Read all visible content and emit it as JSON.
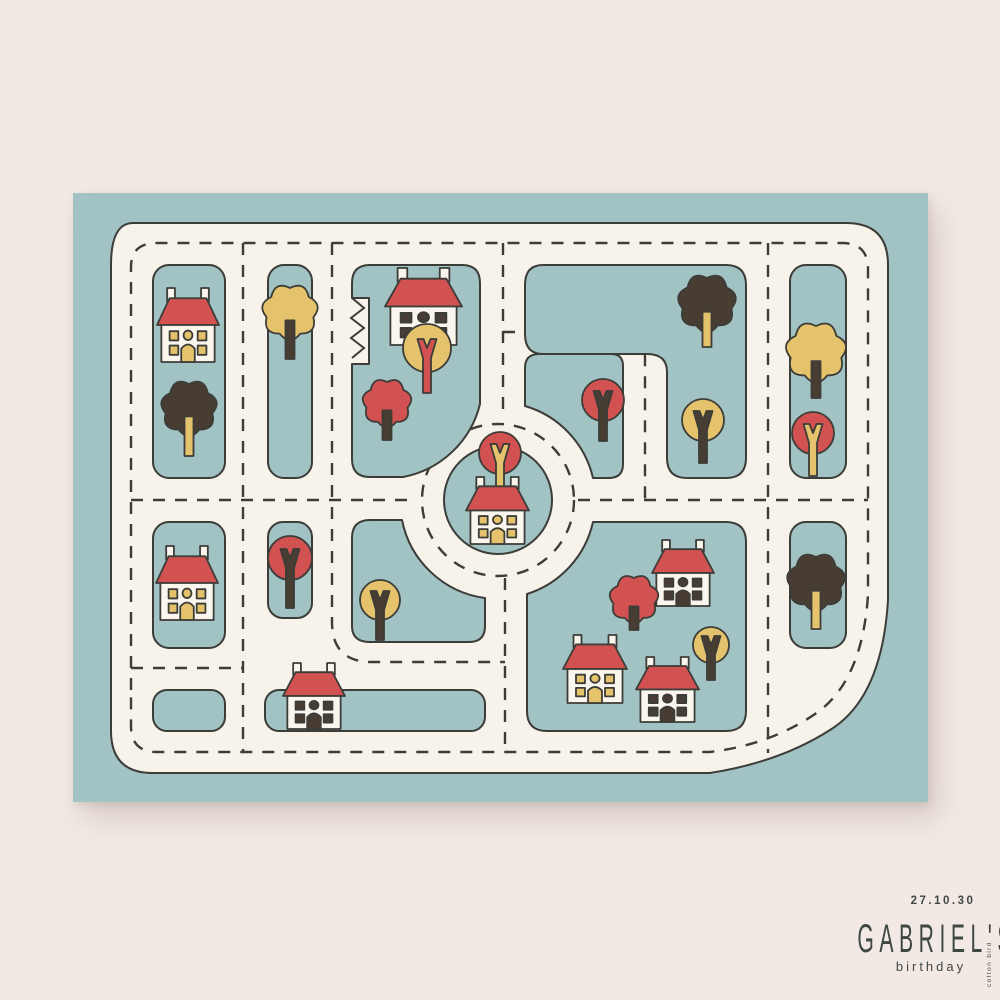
{
  "poster": {
    "date": "27.10.30",
    "name": "GABRIEL'S",
    "subtitle": "birthday",
    "brand": "cotton bird",
    "colors": {
      "bg": "#f2e9e5",
      "teal": "#a2c3c4",
      "cream": "#f7f3ea",
      "outline": "#3c3c38",
      "red": "#d25251",
      "yellow": "#e5c36c",
      "dark": "#473d33",
      "body": "#faf6ee",
      "text": "#3f4743"
    },
    "houses": [
      {
        "x": 157,
        "y": 288,
        "w": 62,
        "h": 74,
        "windows": "yellow"
      },
      {
        "x": 156,
        "y": 546,
        "w": 62,
        "h": 74,
        "windows": "yellow"
      },
      {
        "x": 385,
        "y": 268,
        "w": 77,
        "h": 77,
        "windows": "dark"
      },
      {
        "x": 466,
        "y": 477,
        "w": 63,
        "h": 67,
        "windows": "yellow"
      },
      {
        "x": 652,
        "y": 540,
        "w": 62,
        "h": 66,
        "windows": "dark"
      },
      {
        "x": 563,
        "y": 635,
        "w": 64,
        "h": 68,
        "windows": "yellow"
      },
      {
        "x": 636,
        "y": 657,
        "w": 63,
        "h": 65,
        "windows": "dark"
      },
      {
        "x": 283,
        "y": 663,
        "w": 62,
        "h": 66,
        "windows": "dark"
      }
    ],
    "trees": [
      {
        "type": "spiky",
        "crown": "dark",
        "trunk": "yellow",
        "x": 189,
        "y": 408,
        "r": 24,
        "len": 48
      },
      {
        "type": "spiky",
        "crown": "yellow",
        "trunk": "dark",
        "x": 290,
        "y": 312,
        "r": 24,
        "len": 47
      },
      {
        "type": "round",
        "crown": "yellow",
        "trunk": "red",
        "x": 427,
        "y": 348,
        "r": 24,
        "len": 45
      },
      {
        "type": "spiky",
        "crown": "red",
        "trunk": "dark",
        "x": 387,
        "y": 403,
        "r": 21,
        "len": 37
      },
      {
        "type": "round",
        "crown": "red",
        "trunk": "dark",
        "x": 603,
        "y": 400,
        "r": 21,
        "len": 41
      },
      {
        "type": "spiky",
        "crown": "dark",
        "trunk": "yellow",
        "x": 707,
        "y": 303,
        "r": 25,
        "len": 44
      },
      {
        "type": "round",
        "crown": "yellow",
        "trunk": "dark",
        "x": 703,
        "y": 420,
        "r": 21,
        "len": 43
      },
      {
        "type": "spiky",
        "crown": "yellow",
        "trunk": "dark",
        "x": 816,
        "y": 352,
        "r": 26,
        "len": 46
      },
      {
        "type": "round",
        "crown": "red",
        "trunk": "yellow",
        "x": 813,
        "y": 433,
        "r": 21,
        "len": 43
      },
      {
        "type": "spiky",
        "crown": "dark",
        "trunk": "yellow",
        "x": 816,
        "y": 582,
        "r": 25,
        "len": 47
      },
      {
        "type": "round",
        "crown": "red",
        "trunk": "dark",
        "x": 290,
        "y": 558,
        "r": 22,
        "len": 50
      },
      {
        "type": "round",
        "crown": "yellow",
        "trunk": "dark",
        "x": 380,
        "y": 600,
        "r": 20,
        "len": 40
      },
      {
        "type": "round",
        "crown": "red",
        "trunk": "yellow",
        "x": 500,
        "y": 453,
        "r": 21,
        "len": 38,
        "behind_house": true
      },
      {
        "type": "spiky",
        "crown": "red",
        "trunk": "dark",
        "x": 634,
        "y": 599,
        "r": 21,
        "len": 31
      },
      {
        "type": "round",
        "crown": "yellow",
        "trunk": "dark",
        "x": 711,
        "y": 645,
        "r": 18,
        "len": 35
      }
    ]
  }
}
